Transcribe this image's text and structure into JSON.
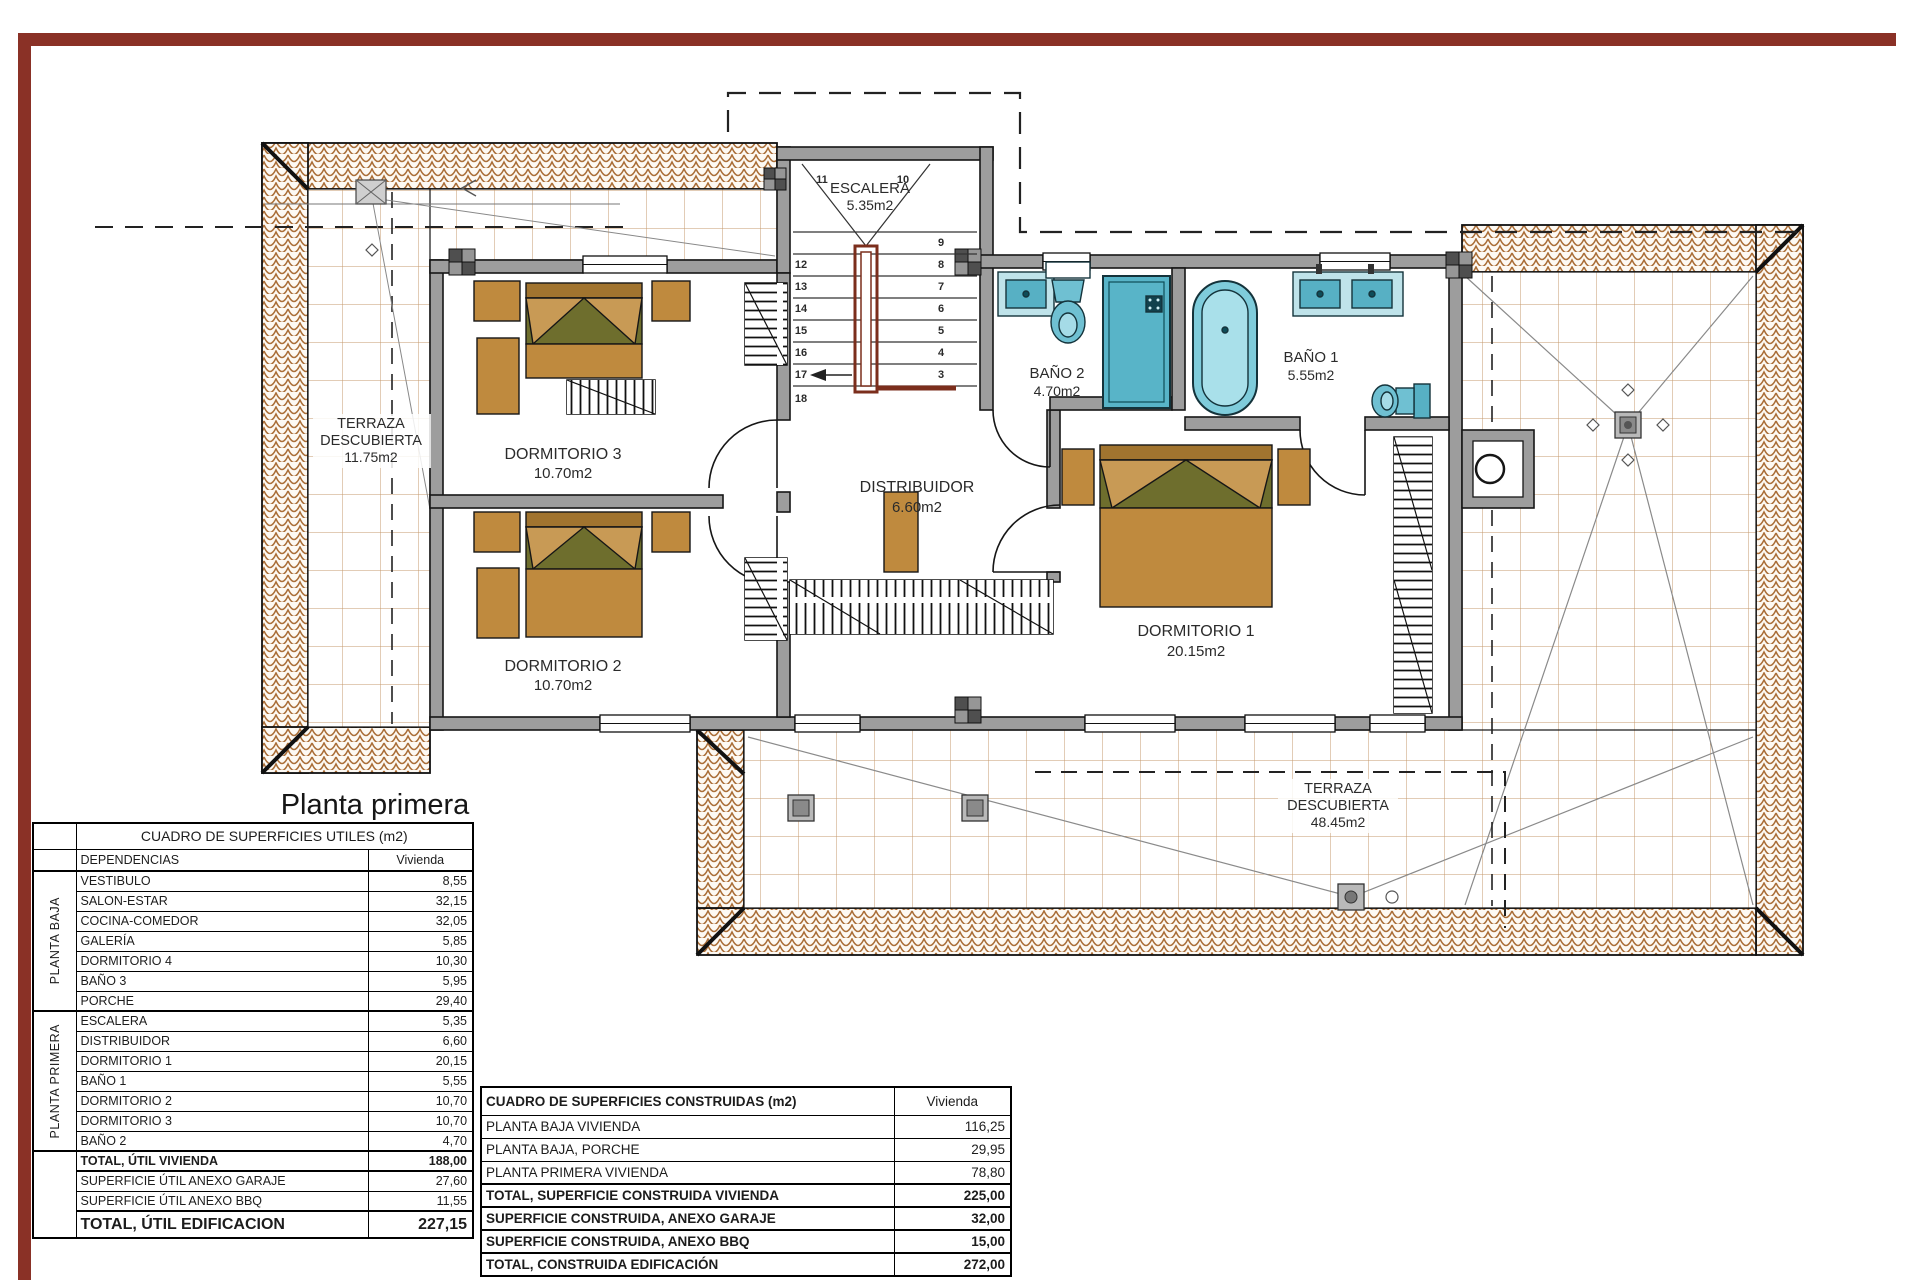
{
  "sheet": {
    "title": "Planta primera",
    "palette": {
      "frame_red": "#8a3126",
      "wall_gray": "#9d9d9d",
      "roof_tile_orange": "#aa6e38",
      "floor_grid_tan": "#c49a6c",
      "fixture_teal": "#5fb7c9",
      "furniture_tan": "#bf8a3e",
      "stair_railing_red": "#7b2e1c"
    }
  },
  "plan": {
    "rooms": {
      "escalera": {
        "name": "ESCALERA",
        "area": "5.35m2"
      },
      "dormitorio3": {
        "name": "DORMITORIO 3",
        "area": "10.70m2"
      },
      "dormitorio2": {
        "name": "DORMITORIO 2",
        "area": "10.70m2"
      },
      "dormitorio1": {
        "name": "DORMITORIO 1",
        "area": "20.15m2"
      },
      "distribuidor": {
        "name": "DISTRIBUIDOR",
        "area": "6.60m2"
      },
      "bano2": {
        "name": "BAÑO 2",
        "area": "4.70m2"
      },
      "bano1": {
        "name": "BAÑO 1",
        "area": "5.55m2"
      },
      "terraza_izq": {
        "line1": "TERRAZA",
        "line2": "DESCUBIERTA",
        "area": "11.75m2"
      },
      "terraza_inf": {
        "line1": "TERRAZA",
        "line2": "DESCUBIERTA",
        "area": "48.45m2"
      }
    },
    "stairs": {
      "top": [
        "11",
        "10"
      ],
      "left": [
        "12",
        "13",
        "14",
        "15",
        "16",
        "17",
        "18"
      ],
      "right": [
        "9",
        "8",
        "7",
        "6",
        "5",
        "4",
        "3"
      ]
    }
  },
  "tables": {
    "utiles": {
      "title": "CUADRO DE SUPERFICIES UTILES (m2)",
      "col_dependencias": "DEPENDENCIAS",
      "col_vivienda": "Vivienda",
      "groups": [
        {
          "label": "PLANTA BAJA",
          "rows": [
            [
              "VESTIBULO",
              "8,55"
            ],
            [
              "SALON-ESTAR",
              "32,15"
            ],
            [
              "COCINA-COMEDOR",
              "32,05"
            ],
            [
              "GALERÍA",
              "5,85"
            ],
            [
              "DORMITORIO 4",
              "10,30"
            ],
            [
              "BAÑO 3",
              "5,95"
            ],
            [
              "PORCHE",
              "29,40"
            ]
          ]
        },
        {
          "label": "PLANTA PRIMERA",
          "rows": [
            [
              "ESCALERA",
              "5,35"
            ],
            [
              "DISTRIBUIDOR",
              "6,60"
            ],
            [
              "DORMITORIO 1",
              "20,15"
            ],
            [
              "BAÑO 1",
              "5,55"
            ],
            [
              "DORMITORIO 2",
              "10,70"
            ],
            [
              "DORMITORIO 3",
              "10,70"
            ],
            [
              "BAÑO 2",
              "4,70"
            ]
          ]
        }
      ],
      "totals": [
        {
          "label": "TOTAL, ÚTIL VIVIENDA",
          "value": "188,00"
        },
        {
          "label": "SUPERFICIE ÚTIL ANEXO GARAJE",
          "value": "27,60"
        },
        {
          "label": "SUPERFICIE ÚTIL ANEXO BBQ",
          "value": "11,55"
        },
        {
          "label": "TOTAL, ÚTIL EDIFICACION",
          "value": "227,15"
        }
      ]
    },
    "construidas": {
      "title": "CUADRO DE SUPERFICIES CONSTRUIDAS (m2)",
      "col_vivienda": "Vivienda",
      "rows": [
        {
          "label": "PLANTA BAJA VIVIENDA",
          "value": "116,25"
        },
        {
          "label": "PLANTA BAJA, PORCHE",
          "value": "29,95"
        },
        {
          "label": "PLANTA PRIMERA VIVIENDA",
          "value": "78,80"
        },
        {
          "label": "TOTAL, SUPERFICIE CONSTRUIDA VIVIENDA",
          "value": "225,00"
        },
        {
          "label": "SUPERFICIE CONSTRUIDA, ANEXO GARAJE",
          "value": "32,00"
        },
        {
          "label": "SUPERFICIE CONSTRUIDA, ANEXO BBQ",
          "value": "15,00"
        },
        {
          "label": "TOTAL, CONSTRUIDA EDIFICACIÓN",
          "value": "272,00"
        }
      ]
    }
  }
}
